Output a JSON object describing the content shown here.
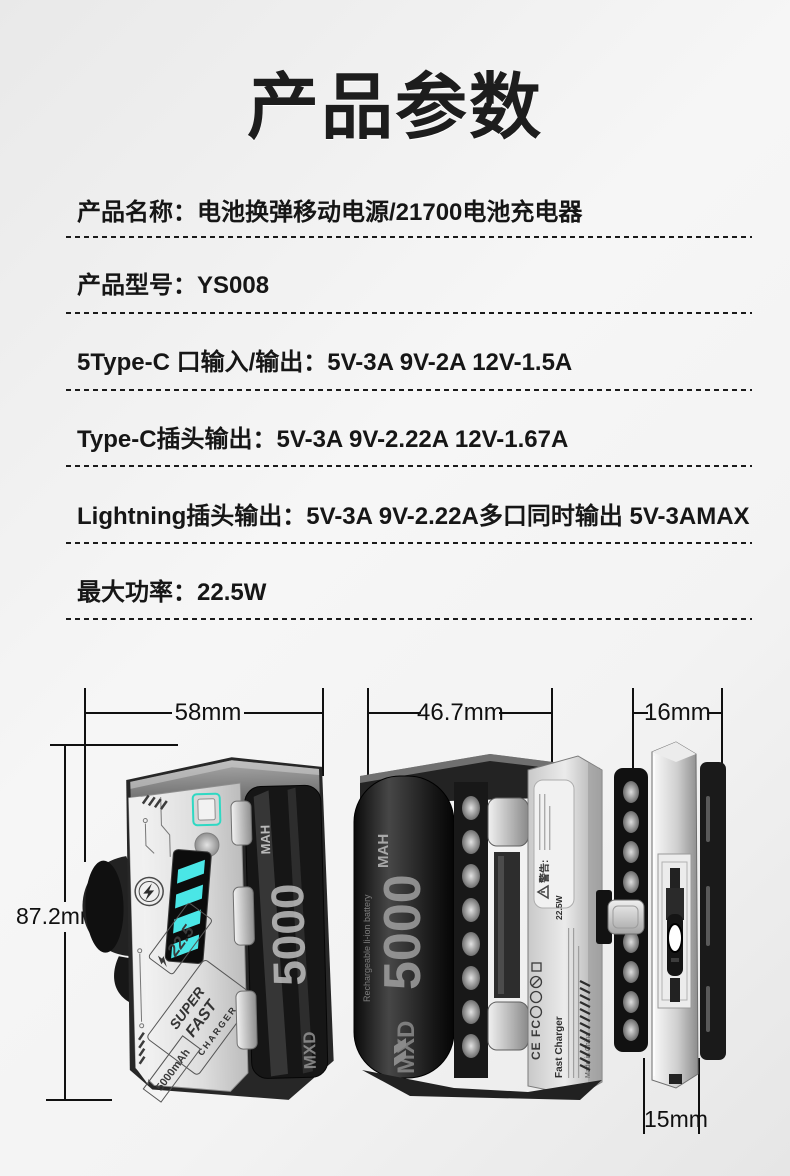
{
  "page": {
    "title": "产品参数"
  },
  "specs": {
    "rows": [
      {
        "text": "产品名称：电池换弹移动电源/21700电池充电器"
      },
      {
        "text": "产品型号：YS008"
      },
      {
        "text": "5Type-C 口输入/输出：5V-3A 9V-2A 12V-1.5A"
      },
      {
        "text": "Type-C插头输出：5V-3A 9V-2.22A 12V-1.67A"
      },
      {
        "text": "Lightning插头输出：5V-3A 9V-2.22A多口同时输出 5V-3AMAX"
      },
      {
        "text": "最大功率：22.5W"
      }
    ]
  },
  "dimensions": {
    "front_width": "58mm",
    "back_width": "46.7mm",
    "side_width": "16mm",
    "height": "87.2mm",
    "plug_width": "15mm"
  },
  "device_front": {
    "power_badge": "22.5",
    "slogan_line1": "SUPER",
    "slogan_line2": "FAST",
    "slogan_line3": "CHARGER",
    "capacity_label": "5000mAh",
    "battery_value": "5000",
    "battery_unit": "MAH",
    "battery_brand": "MXD"
  },
  "device_back": {
    "battery_value": "5000",
    "battery_unit": "MAH",
    "battery_brand": "MXD",
    "battery_note": "Rechargeable li-ion battery",
    "warning_label": "警告:",
    "label_title": "Fast Charger",
    "label_power": "22.5W",
    "label_certs": "CE FC",
    "label_made_in": "Made in China"
  },
  "colors": {
    "accent_cyan": "#4ae6e6",
    "button_trim": "#2fd8c3",
    "text": "#1a1a1a"
  }
}
